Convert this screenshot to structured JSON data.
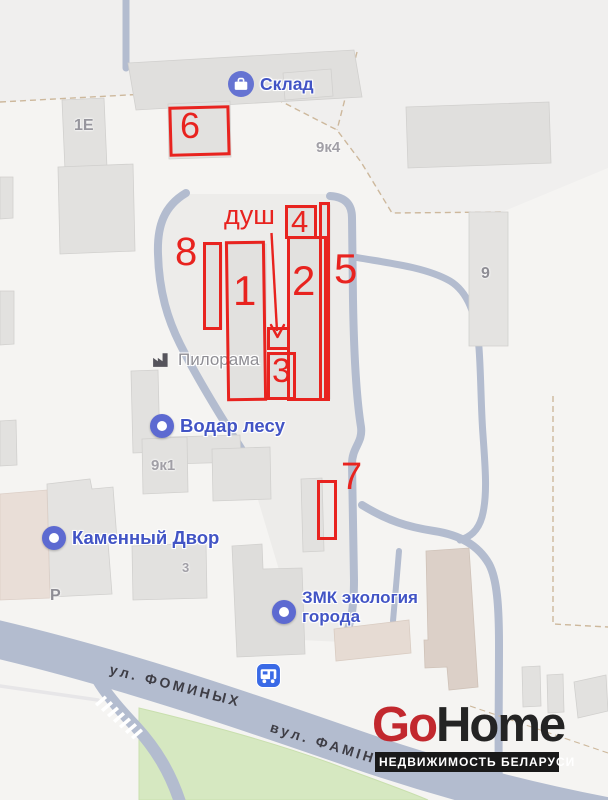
{
  "map": {
    "pois": {
      "sklad": {
        "label": "Склад"
      },
      "pilorama": {
        "label": "Пилорама"
      },
      "vodar_lesu": {
        "label": "Водар лесу"
      },
      "kamenny_dvor": {
        "label": "Каменный Двор"
      },
      "zmk": {
        "line1": "ЗМК экология",
        "line2": "города"
      }
    },
    "building_labels": {
      "b_1e": "1Е",
      "b_9k4": "9к4",
      "b_9k1": "9к1",
      "b_3": "3",
      "b_9": "9",
      "parking": "Р"
    },
    "streets": {
      "fominykh_ru": "ул. ФОМИНЫХ",
      "fominykh_be": "вул. ФАМІНЫХ"
    },
    "annotations": {
      "dush_label": "душ",
      "n1": "1",
      "n2": "2",
      "n3": "3",
      "n4": "4",
      "n5": "5",
      "n6": "6",
      "n7": "7",
      "n8": "8",
      "color": "#e8231f"
    },
    "colors": {
      "road": "#b3bccf",
      "building": "#e2e1df",
      "green": "#d6e8c1",
      "label_blue": "#4254c5",
      "label_gray": "#a19fa6"
    }
  },
  "watermark": {
    "brand_go": "Go",
    "brand_home": "Home",
    "tagline": "НЕДВИЖИМОСТЬ БЕЛАРУСИ"
  }
}
